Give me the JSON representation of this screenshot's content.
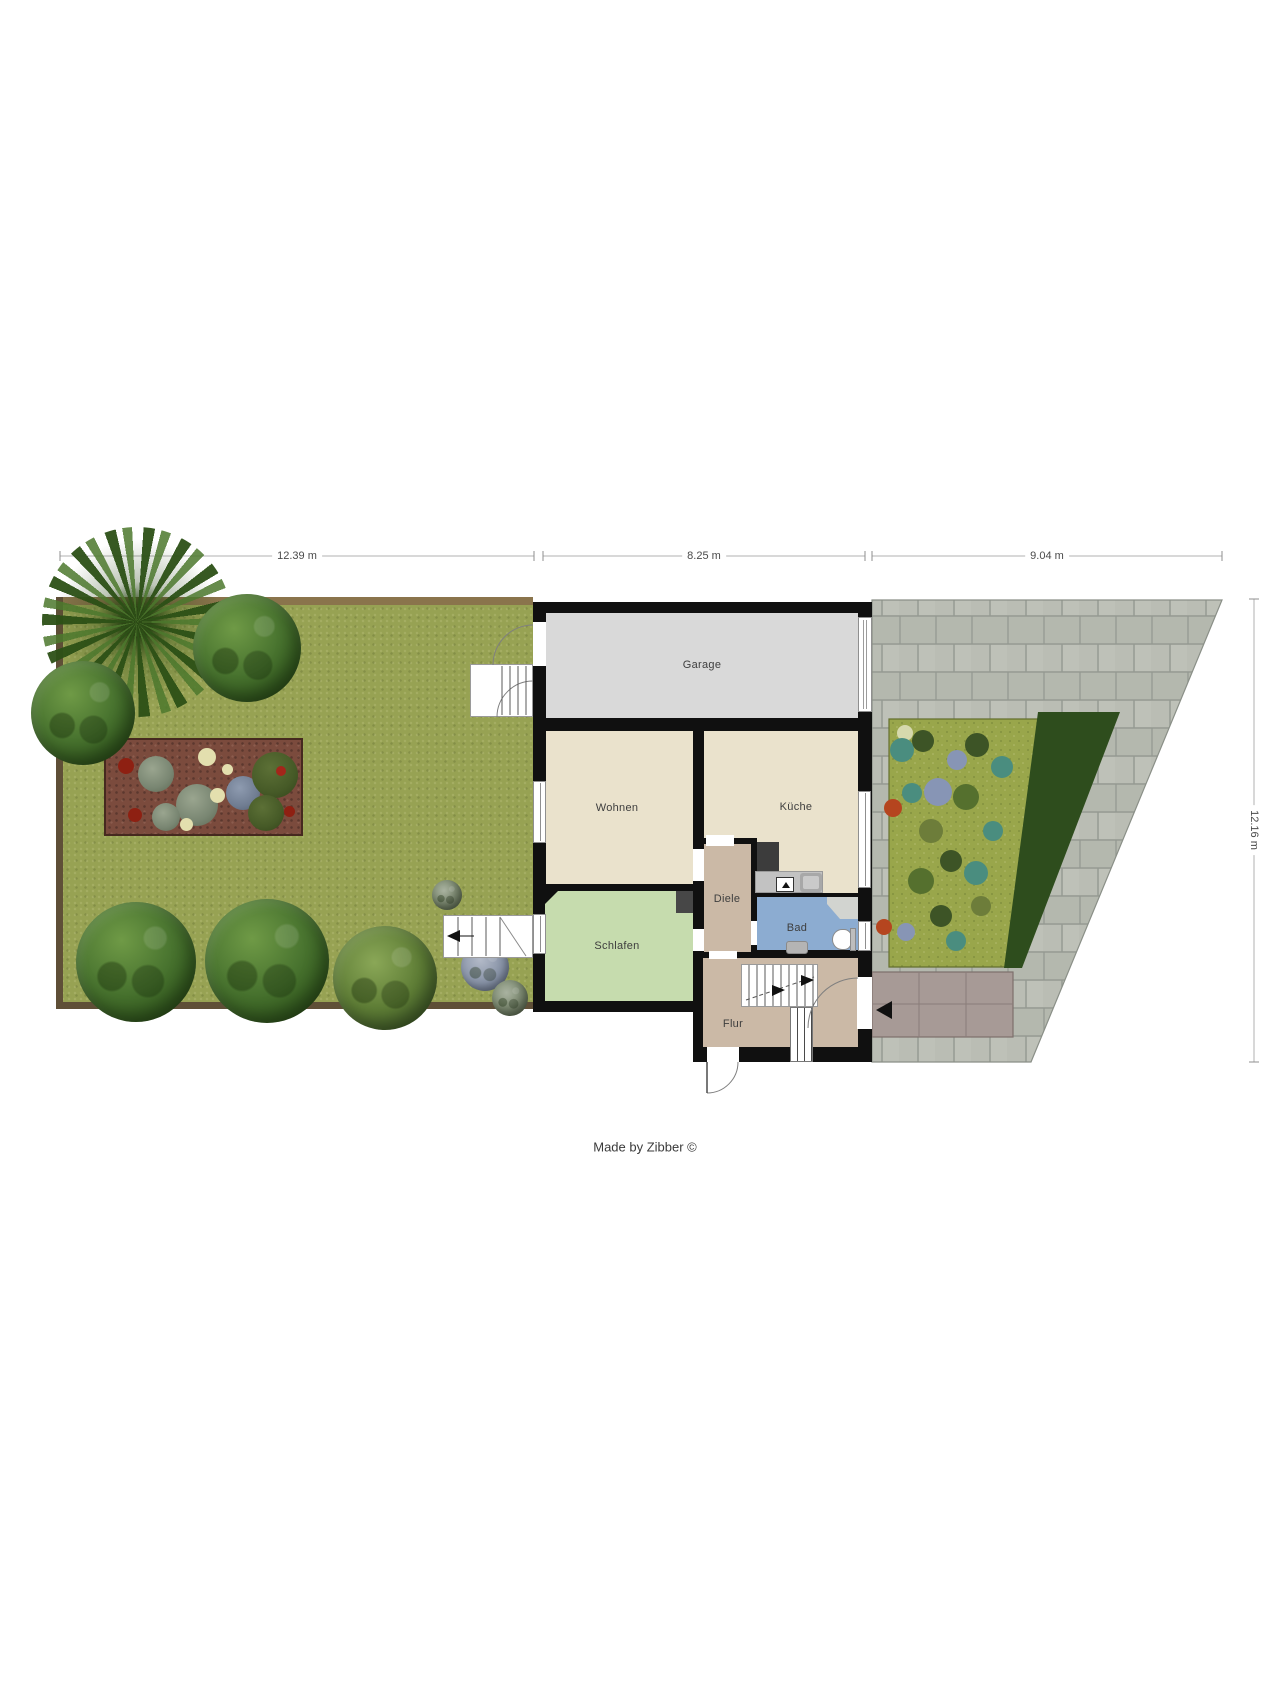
{
  "meta": {
    "footer": "Made by Zibber ©"
  },
  "dimensions": {
    "top": [
      {
        "label": "12.39 m"
      },
      {
        "label": "8.25 m"
      },
      {
        "label": "9.04 m"
      }
    ],
    "right": {
      "label": "12.16 m"
    }
  },
  "rooms": {
    "garage": {
      "label": "Garage",
      "color": "#d9d9d9"
    },
    "wohnen": {
      "label": "Wohnen",
      "color": "#eae2cc"
    },
    "kueche": {
      "label": "Küche",
      "color": "#eae2cc"
    },
    "diele": {
      "label": "Diele",
      "color": "#cbb9a6"
    },
    "bad": {
      "label": "Bad",
      "color": "#8cacd1"
    },
    "schlafen": {
      "label": "Schlafen",
      "color": "#c6dcae"
    },
    "flur": {
      "label": "Flur",
      "color": "#cbb9a6"
    }
  },
  "site": {
    "grass_color": "#97a253",
    "right_bed_color": "#99a64b",
    "paving_color": "#babdb4",
    "porch_color": "#a79a96",
    "hedge_color": "#2e4d1d",
    "wall_color": "#101010",
    "flower_bed_soil_color": "#7b4b3d"
  },
  "icons": {
    "entrance_arrow": "left-arrow",
    "stair_direction": "right-arrow"
  }
}
